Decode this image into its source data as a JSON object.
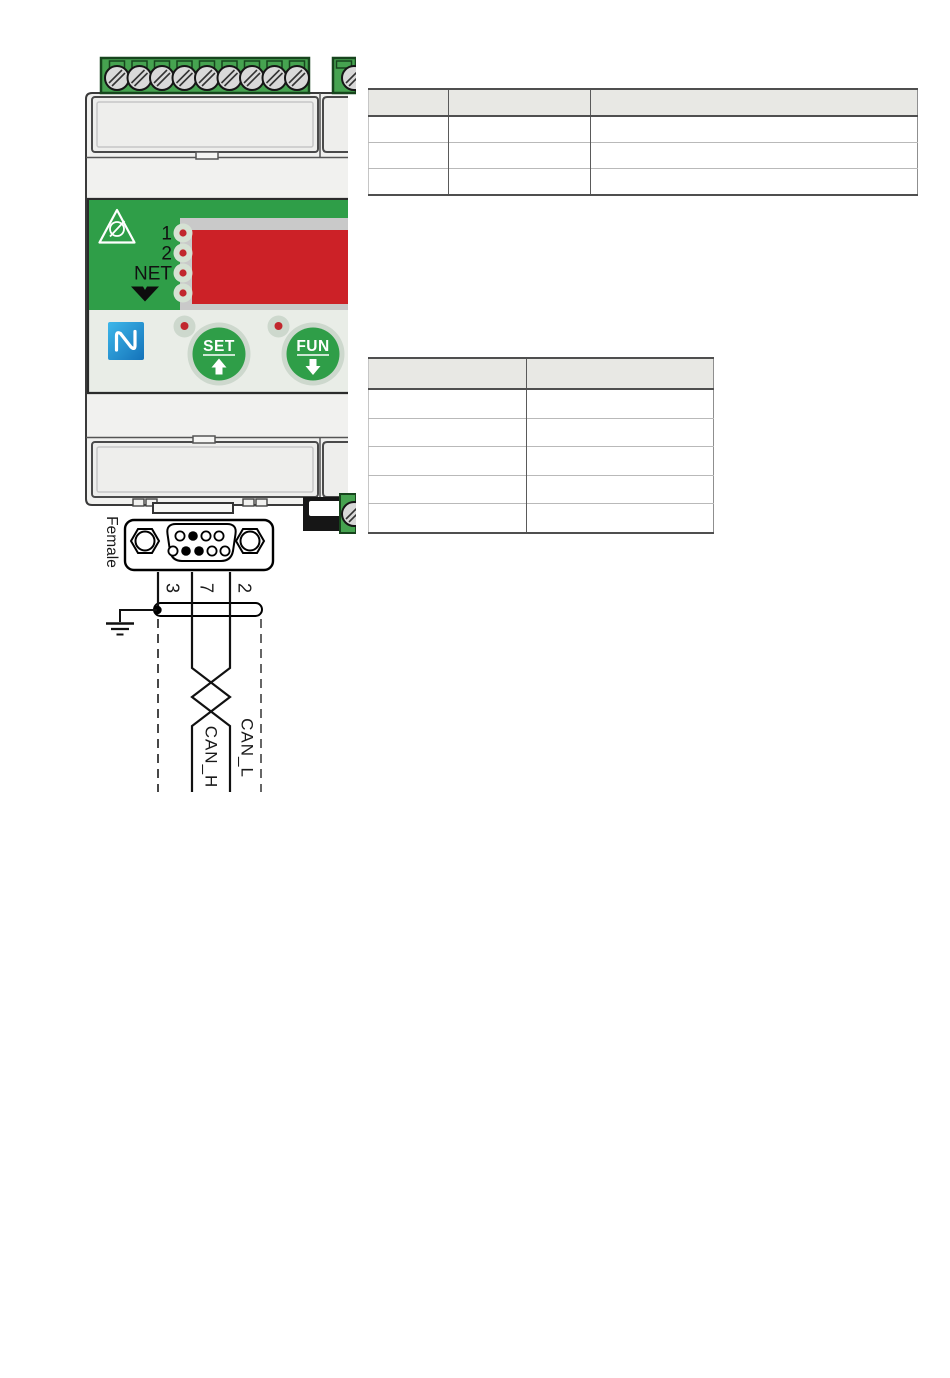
{
  "page": {
    "background": "#ffffff"
  },
  "illustration": {
    "device": {
      "led_labels": [
        "1",
        "2",
        "NET"
      ],
      "buttons": [
        {
          "label": "SET"
        },
        {
          "label": "FUN"
        }
      ],
      "colors": {
        "panel_green": "#2f9e48",
        "terminal_green": "#46a350",
        "terminal_border": "#17451d",
        "display_red": "#cc2127",
        "led_red": "#c1272d",
        "button_ring_grey": "#cdd8cd",
        "body_grey": "#f1f1ef",
        "nfc_blue": "#29abe2",
        "table_header_fill": "#e8e8e4"
      }
    },
    "connector": {
      "gender_label": "Female"
    },
    "wiring": {
      "pin_numbers": [
        "3",
        "7",
        "2"
      ],
      "wire_labels": [
        "CAN_H",
        "CAN_L"
      ]
    }
  },
  "tables": {
    "top_table": {
      "columns": [
        "",
        "",
        ""
      ],
      "rows": [
        [
          "",
          "",
          ""
        ],
        [
          "",
          "",
          ""
        ],
        [
          "",
          "",
          ""
        ]
      ]
    },
    "right_table": {
      "columns": [
        "",
        ""
      ],
      "rows": [
        [
          "",
          ""
        ],
        [
          "",
          ""
        ],
        [
          "",
          ""
        ],
        [
          "",
          ""
        ],
        [
          "",
          ""
        ]
      ]
    }
  }
}
